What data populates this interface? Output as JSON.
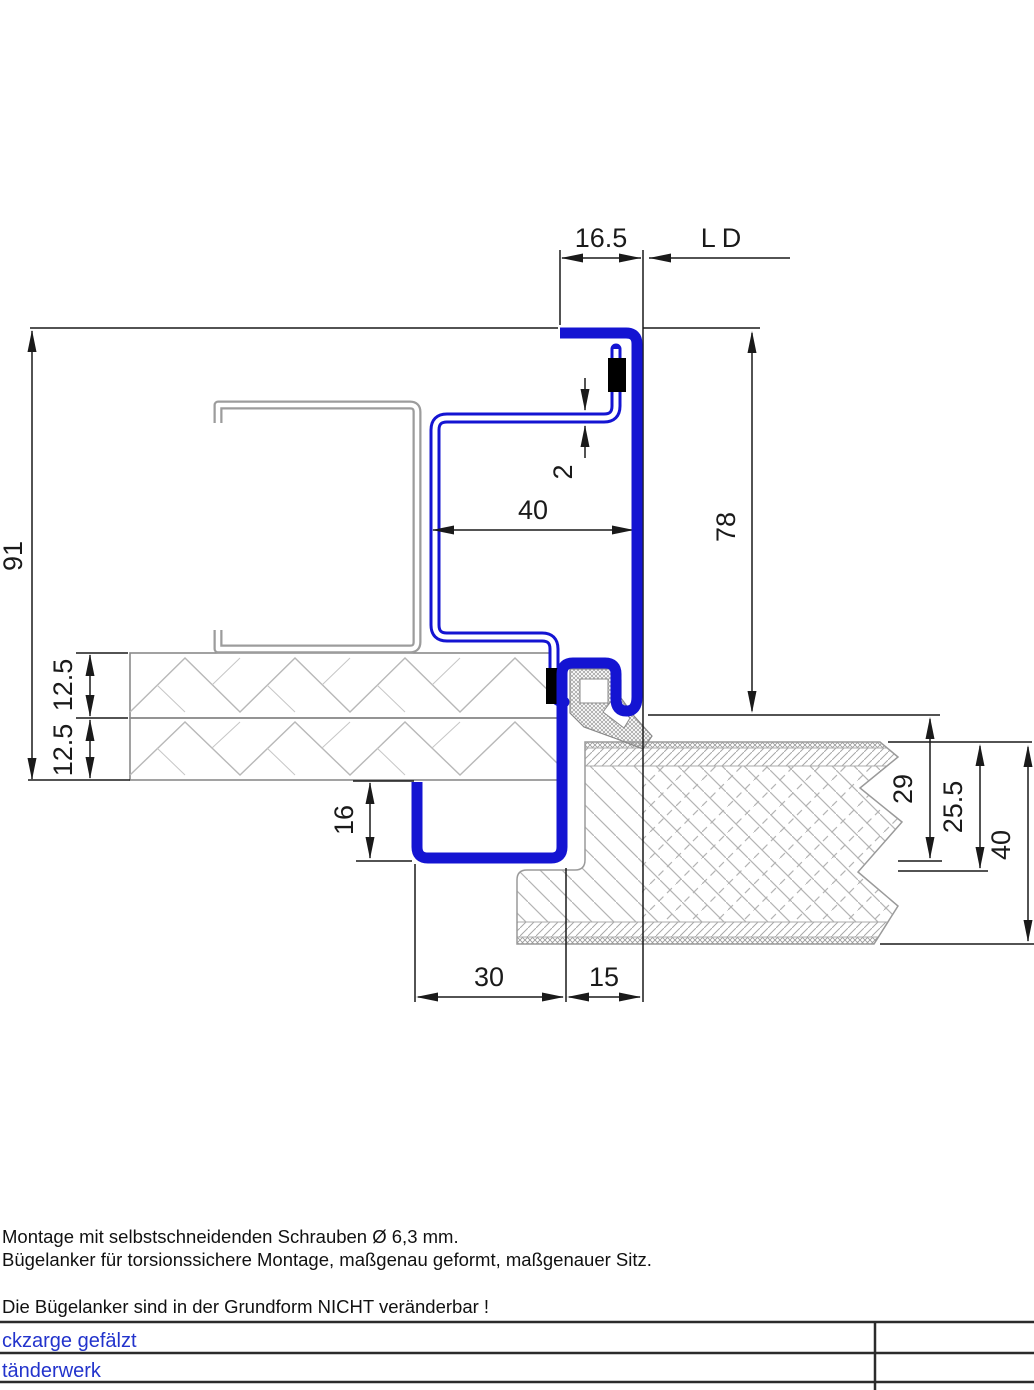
{
  "drawing": {
    "dimensions": {
      "frame_face_width": "16.5",
      "clear_opening": "LD",
      "sheet_thickness": "2",
      "stud_depth": "40",
      "frame_rebate_height": "78",
      "frame_overall_height": "91",
      "board_layer_1": "12.5",
      "board_layer_2": "12.5",
      "return_leg": "16",
      "bottom_width_left": "30",
      "bottom_width_right": "15",
      "door_rebate_depth": "29",
      "door_overlap_depth": "25.5",
      "door_thickness": "40"
    },
    "colors": {
      "profile_blue": "#1414d2",
      "dimension_black": "#1a1a1a",
      "hatch_gray": "#b4b4b4",
      "label_blue": "#2233cc"
    }
  },
  "notes": {
    "line1": "Montage mit selbstschneidenden Schrauben Ø 6,3 mm.",
    "line2": "Bügelanker für torsionssichere Montage, maßgenau geformt, maßgenauer Sitz.",
    "line3": "Die Bügelanker sind in der Grundform NICHT veränderbar !"
  },
  "titleblock": {
    "row1": "ckzarge gefälzt",
    "row2": "tänderwerk"
  }
}
